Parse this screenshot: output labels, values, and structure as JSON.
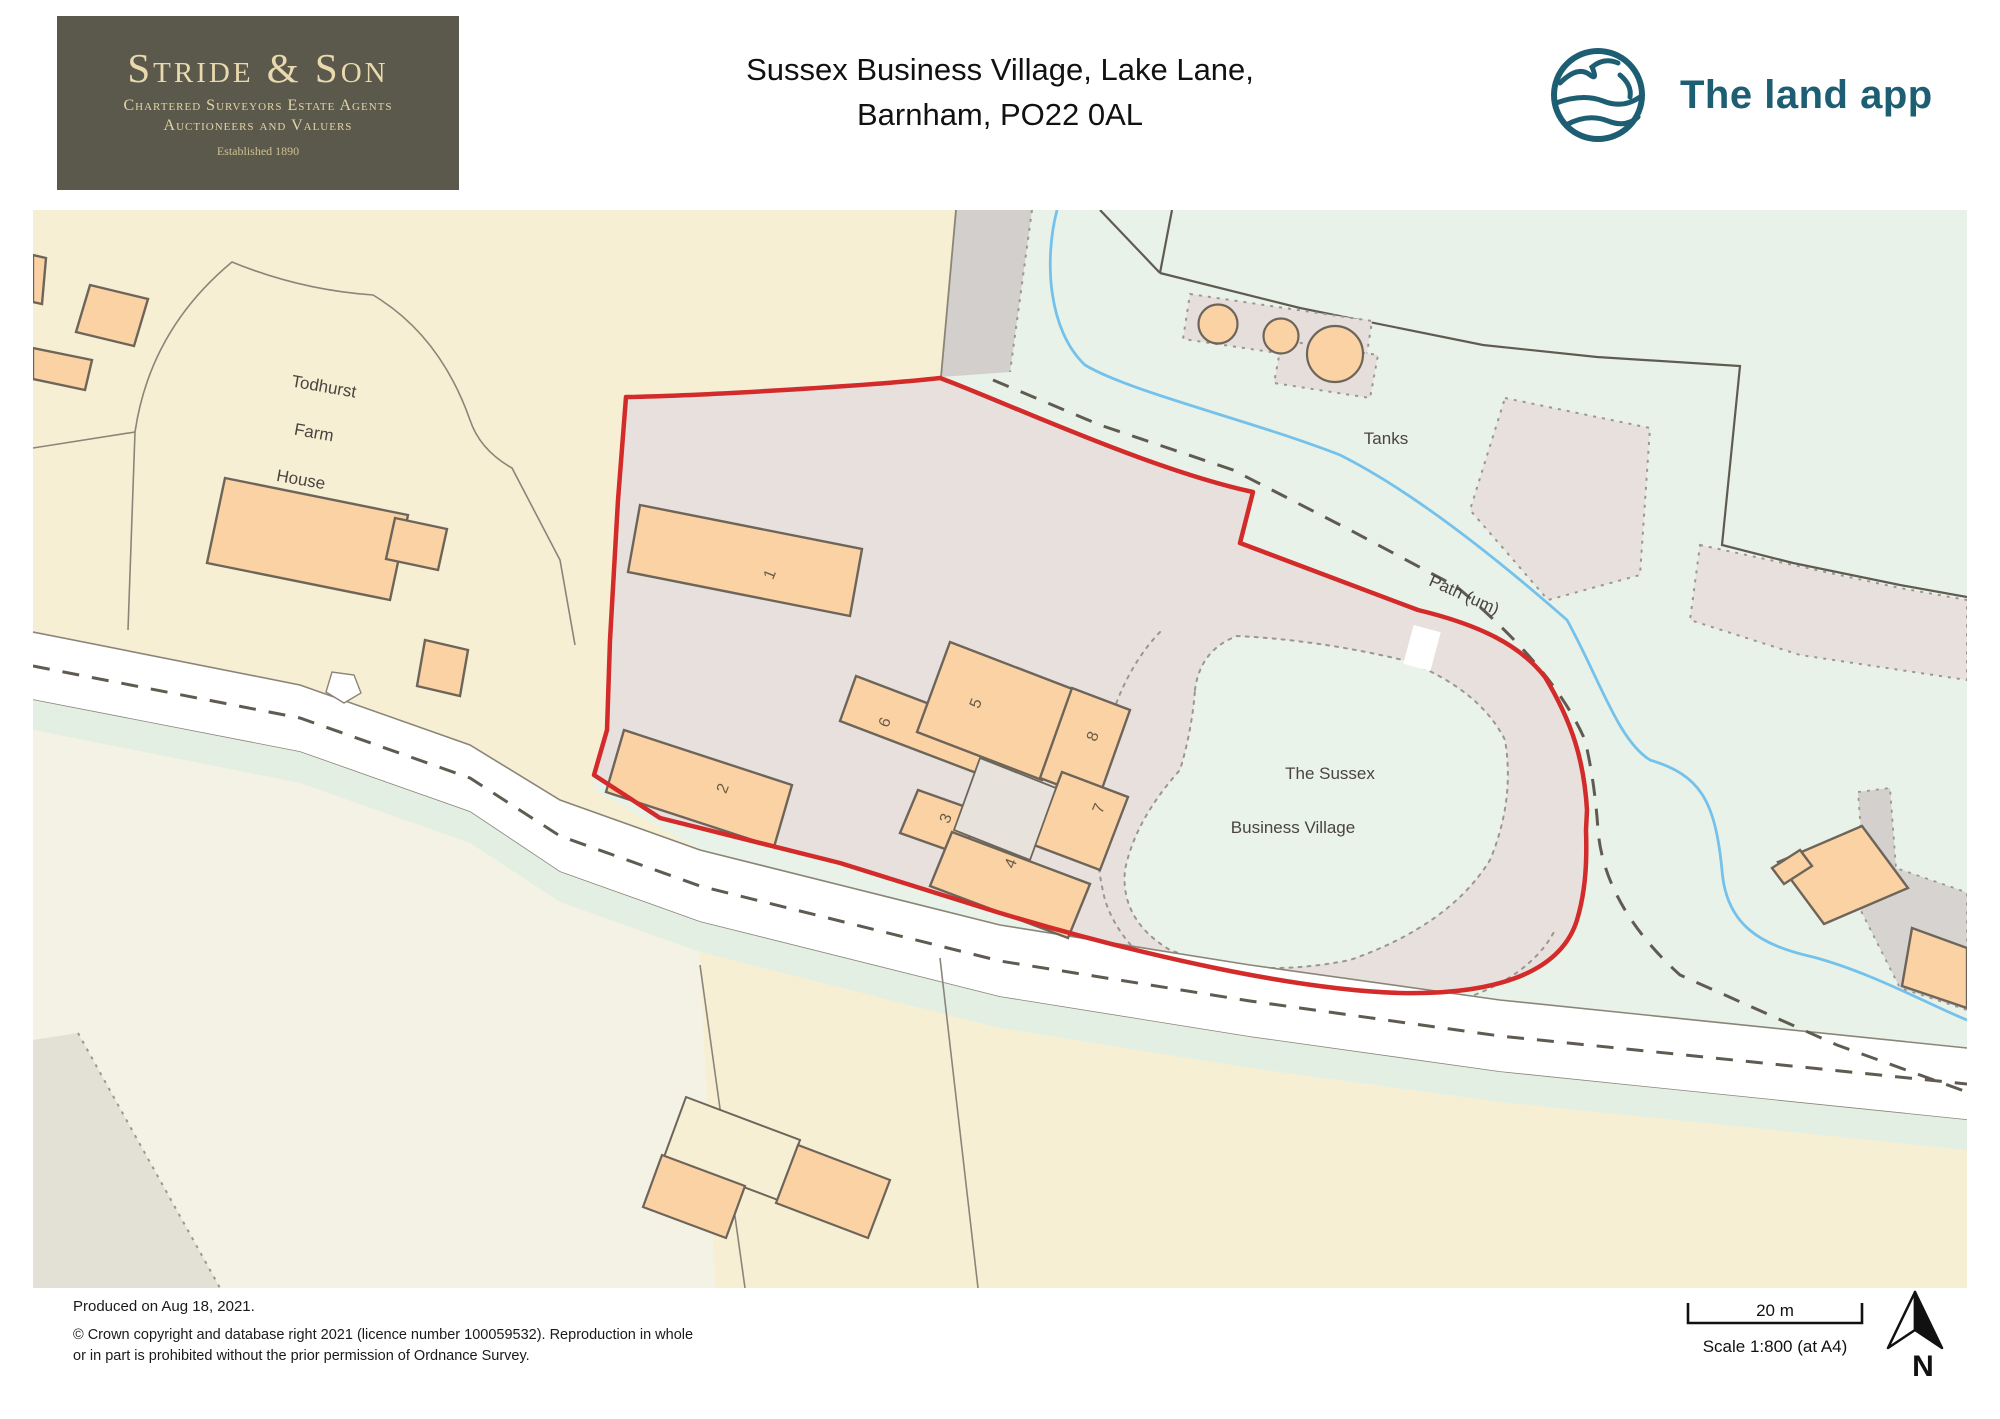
{
  "header": {
    "logo": {
      "name": "Stride & Son",
      "line1": "Chartered Surveyors Estate Agents",
      "line2": "Auctioneers and Valuers",
      "line3": "Established 1890"
    },
    "title": {
      "line1": "Sussex Business Village, Lake Lane,",
      "line2": "Barnham, PO22 0AL"
    },
    "brand": {
      "name": "The land app"
    }
  },
  "map": {
    "labels": {
      "todhurst1": "Todhurst",
      "todhurst2": "Farm",
      "todhurst3": "House",
      "tanks": "Tanks",
      "path": "Path (um)",
      "sussex1": "The Sussex",
      "sussex2": "Business Village"
    },
    "plots": [
      "1",
      "2",
      "3",
      "4",
      "5",
      "6",
      "7",
      "8"
    ]
  },
  "footer": {
    "produced": "Produced on Aug 18, 2021.",
    "copyright1": "© Crown copyright and database right 2021 (licence number 100059532). Reproduction in whole",
    "copyright2": "or in part is prohibited without the prior permission of Ordnance Survey."
  },
  "scale": {
    "distance": "20 m",
    "ratio": "Scale 1:800 (at A4)",
    "north": "N"
  },
  "colors": {
    "boundary_red": "#d22b2a",
    "brand_teal": "#1d5e73",
    "logo_bg": "#5b594b",
    "building_orange": "#fad2a4",
    "map_cream": "#f7efd4",
    "map_mint": "#e9f2e8",
    "site_grey": "#e8e0dd",
    "stream_blue": "#74c2ec"
  }
}
